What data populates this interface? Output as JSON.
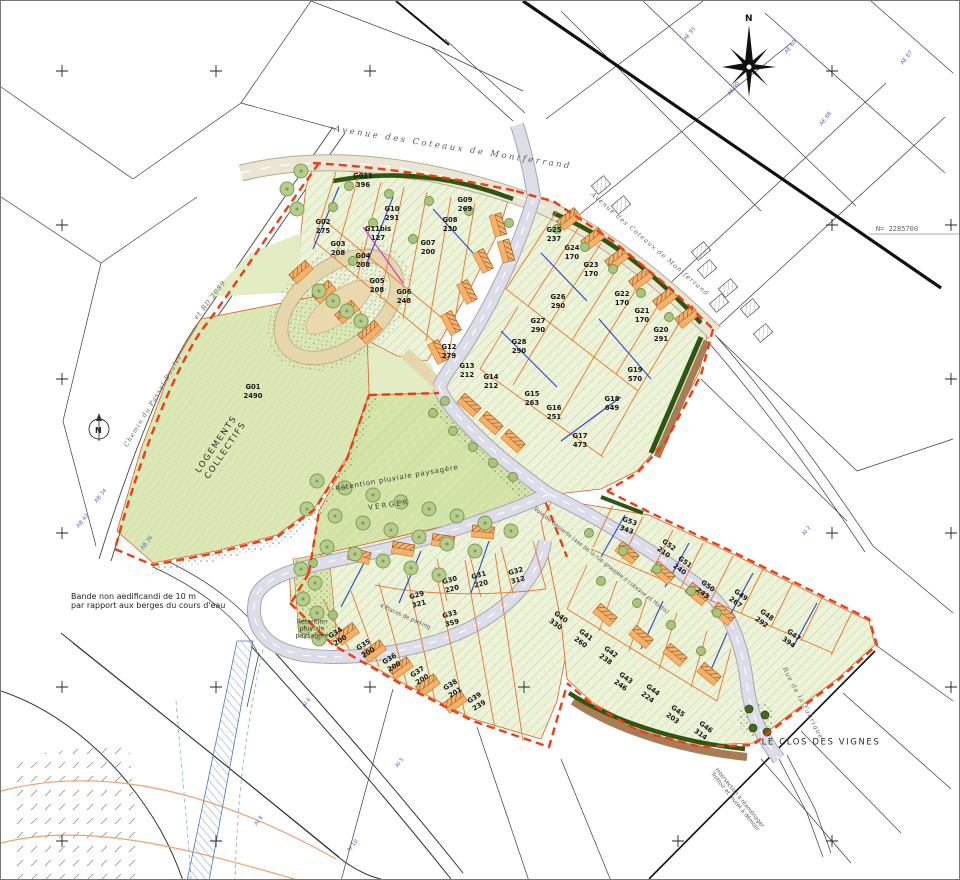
{
  "site": {
    "name": "LE CLOS DES VIGNES"
  },
  "compass": {
    "letter": "N"
  },
  "north_arrow": {
    "letter": "N"
  },
  "colors": {
    "site_green": "#edf3d9",
    "deep_green": "#dce9b6",
    "hedge_green": "#2d5711",
    "boundary_red": "#f03c10",
    "parcel_orange": "#e8762c",
    "road_gray": "#dcdde8",
    "avenue_beige": "#ebe6d4",
    "garage_orange": "#f5b06a",
    "utility_blue": "#2b43cc",
    "water_blue": "#4a7ab0",
    "contour_orange": "#f0a070"
  },
  "parcels": [
    {
      "id": "G01",
      "area": "2490",
      "x": 252,
      "y": 391,
      "rot": 0
    },
    {
      "id": "G02",
      "area": "275",
      "x": 322,
      "y": 226,
      "rot": 0
    },
    {
      "id": "G03",
      "area": "208",
      "x": 337,
      "y": 248,
      "rot": 0
    },
    {
      "id": "G04",
      "area": "208",
      "x": 362,
      "y": 260,
      "rot": 0
    },
    {
      "id": "G05",
      "area": "208",
      "x": 376,
      "y": 285,
      "rot": 0
    },
    {
      "id": "G06",
      "area": "248",
      "x": 403,
      "y": 296,
      "rot": 0
    },
    {
      "id": "G07",
      "area": "200",
      "x": 427,
      "y": 247,
      "rot": 0
    },
    {
      "id": "G08",
      "area": "230",
      "x": 449,
      "y": 224,
      "rot": 0
    },
    {
      "id": "G09",
      "area": "269",
      "x": 464,
      "y": 204,
      "rot": 0
    },
    {
      "id": "G011",
      "area": "396",
      "x": 362,
      "y": 180,
      "rot": 0
    },
    {
      "id": "G10",
      "area": "291",
      "x": 391,
      "y": 213,
      "rot": 0
    },
    {
      "id": "G11bis",
      "area": "127",
      "x": 377,
      "y": 233,
      "rot": 0
    },
    {
      "id": "G12",
      "area": "279",
      "x": 448,
      "y": 351,
      "rot": 0
    },
    {
      "id": "G13",
      "area": "212",
      "x": 466,
      "y": 370,
      "rot": 0
    },
    {
      "id": "G14",
      "area": "212",
      "x": 490,
      "y": 381,
      "rot": 0
    },
    {
      "id": "G15",
      "area": "263",
      "x": 531,
      "y": 398,
      "rot": 0
    },
    {
      "id": "G16",
      "area": "251",
      "x": 553,
      "y": 412,
      "rot": 0
    },
    {
      "id": "G17",
      "area": "473",
      "x": 579,
      "y": 440,
      "rot": 0
    },
    {
      "id": "G18",
      "area": "649",
      "x": 611,
      "y": 403,
      "rot": 0
    },
    {
      "id": "G19",
      "area": "570",
      "x": 634,
      "y": 374,
      "rot": 0
    },
    {
      "id": "G20",
      "area": "291",
      "x": 660,
      "y": 334,
      "rot": 0
    },
    {
      "id": "G21",
      "area": "170",
      "x": 641,
      "y": 315,
      "rot": 0
    },
    {
      "id": "G22",
      "area": "170",
      "x": 621,
      "y": 298,
      "rot": 0
    },
    {
      "id": "G23",
      "area": "170",
      "x": 590,
      "y": 269,
      "rot": 0
    },
    {
      "id": "G24",
      "area": "170",
      "x": 571,
      "y": 252,
      "rot": 0
    },
    {
      "id": "G25",
      "area": "237",
      "x": 553,
      "y": 234,
      "rot": 0
    },
    {
      "id": "G26",
      "area": "290",
      "x": 557,
      "y": 301,
      "rot": 0
    },
    {
      "id": "G27",
      "area": "290",
      "x": 537,
      "y": 325,
      "rot": 0
    },
    {
      "id": "G28",
      "area": "290",
      "x": 518,
      "y": 346,
      "rot": 0
    },
    {
      "id": "G29",
      "area": "321",
      "x": 417,
      "y": 599,
      "rot": -15
    },
    {
      "id": "G30",
      "area": "220",
      "x": 450,
      "y": 584,
      "rot": -15
    },
    {
      "id": "G31",
      "area": "220",
      "x": 479,
      "y": 579,
      "rot": -15
    },
    {
      "id": "G32",
      "area": "312",
      "x": 516,
      "y": 575,
      "rot": -15
    },
    {
      "id": "G33",
      "area": "359",
      "x": 450,
      "y": 618,
      "rot": -15
    },
    {
      "id": "G34",
      "area": "200",
      "x": 337,
      "y": 636,
      "rot": -32
    },
    {
      "id": "G35",
      "area": "200",
      "x": 365,
      "y": 648,
      "rot": -32
    },
    {
      "id": "G36",
      "area": "200",
      "x": 391,
      "y": 662,
      "rot": -32
    },
    {
      "id": "G37",
      "area": "200",
      "x": 419,
      "y": 675,
      "rot": -32
    },
    {
      "id": "G38",
      "area": "201",
      "x": 452,
      "y": 688,
      "rot": -32
    },
    {
      "id": "G39",
      "area": "239",
      "x": 476,
      "y": 701,
      "rot": -32
    },
    {
      "id": "G40",
      "area": "330",
      "x": 557,
      "y": 620,
      "rot": 36
    },
    {
      "id": "G41",
      "area": "260",
      "x": 582,
      "y": 638,
      "rot": 36
    },
    {
      "id": "G42",
      "area": "238",
      "x": 607,
      "y": 655,
      "rot": 36
    },
    {
      "id": "G43",
      "area": "246",
      "x": 622,
      "y": 681,
      "rot": 36
    },
    {
      "id": "G44",
      "area": "224",
      "x": 649,
      "y": 693,
      "rot": 36
    },
    {
      "id": "G45",
      "area": "203",
      "x": 674,
      "y": 714,
      "rot": 36
    },
    {
      "id": "G46",
      "area": "314",
      "x": 702,
      "y": 730,
      "rot": 36
    },
    {
      "id": "G47",
      "area": "394",
      "x": 790,
      "y": 638,
      "rot": 36
    },
    {
      "id": "G48",
      "area": "292",
      "x": 763,
      "y": 618,
      "rot": 36
    },
    {
      "id": "G49",
      "area": "267",
      "x": 737,
      "y": 598,
      "rot": 36
    },
    {
      "id": "G50",
      "area": "243",
      "x": 704,
      "y": 589,
      "rot": 36
    },
    {
      "id": "G51",
      "area": "240",
      "x": 681,
      "y": 565,
      "rot": 36
    },
    {
      "id": "G52",
      "area": "210",
      "x": 665,
      "y": 548,
      "rot": 36
    },
    {
      "id": "G53",
      "area": "343",
      "x": 627,
      "y": 525,
      "rot": 20
    }
  ],
  "labels": [
    {
      "text": "Avenue des Coteaux de Montferrand",
      "x": 452,
      "y": 147,
      "rot": 9,
      "cls": "road"
    },
    {
      "text": "Avenue des Coteaux de Montferrand",
      "x": 649,
      "y": 243,
      "rot": 41,
      "cls": "road-sm"
    },
    {
      "text": "Chemin du Passet Doulet",
      "x": 152,
      "y": 400,
      "rot": -59,
      "cls": "road-sm"
    },
    {
      "text": "et RD 2089",
      "x": 209,
      "y": 299,
      "rot": -52,
      "cls": "road-sm"
    },
    {
      "text": "Rue de la Fabrique",
      "x": 802,
      "y": 702,
      "rot": 62,
      "cls": "road-sm"
    },
    {
      "text": "LOGEMENTS\nCOLLECTIFS",
      "x": 221,
      "y": 447,
      "rot": -56,
      "cls": "caps"
    },
    {
      "text": "LE CLOS DES VIGNES",
      "x": 820,
      "y": 742,
      "rot": 0,
      "cls": "caps"
    },
    {
      "text": "Rétention pluviale paysagère",
      "x": 396,
      "y": 477,
      "rot": -10,
      "cls": "green"
    },
    {
      "text": "VERGER",
      "x": 388,
      "y": 504,
      "rot": -8,
      "cls": "green sp"
    },
    {
      "text": "Rétention\npluviale\npaysagère",
      "x": 311,
      "y": 628,
      "rot": 0,
      "cls": "green-sm"
    },
    {
      "text": "Bande non aedificandi de 10 m\npar rapport aux berges du cours d'eau",
      "x": 70,
      "y": 600,
      "rot": 0,
      "cls": "note",
      "left": true
    },
    {
      "text": "Intersection à réaménager\nTrottoir et muret à démolir",
      "x": 736,
      "y": 799,
      "rot": 51,
      "cls": "tiny"
    },
    {
      "text": "Voie de desserte (axe de la rue groupée // coteaux et Hortis)",
      "x": 600,
      "y": 560,
      "rot": 38,
      "cls": "tiny"
    },
    {
      "text": "4 Places de parking",
      "x": 404,
      "y": 616,
      "rot": 24,
      "cls": "tiny"
    },
    {
      "text": "N= 2285700",
      "x": 896,
      "y": 228,
      "rot": 0,
      "cls": "coord"
    }
  ],
  "cadastre": [
    {
      "text": "AE 91",
      "x": 689,
      "y": 33
    },
    {
      "text": "AE 90",
      "x": 733,
      "y": 88
    },
    {
      "text": "AE 89",
      "x": 790,
      "y": 46
    },
    {
      "text": "AE 88",
      "x": 825,
      "y": 118
    },
    {
      "text": "AE 87",
      "x": 906,
      "y": 57
    },
    {
      "text": "AI 2",
      "x": 806,
      "y": 530
    },
    {
      "text": "AI 5",
      "x": 399,
      "y": 762
    },
    {
      "text": "AI 6",
      "x": 306,
      "y": 702
    },
    {
      "text": "AI 8",
      "x": 258,
      "y": 820
    },
    {
      "text": "AI 10",
      "x": 352,
      "y": 845
    },
    {
      "text": "AB 34",
      "x": 100,
      "y": 495
    },
    {
      "text": "AB 42",
      "x": 82,
      "y": 520
    },
    {
      "text": "AB 36",
      "x": 146,
      "y": 542
    }
  ]
}
